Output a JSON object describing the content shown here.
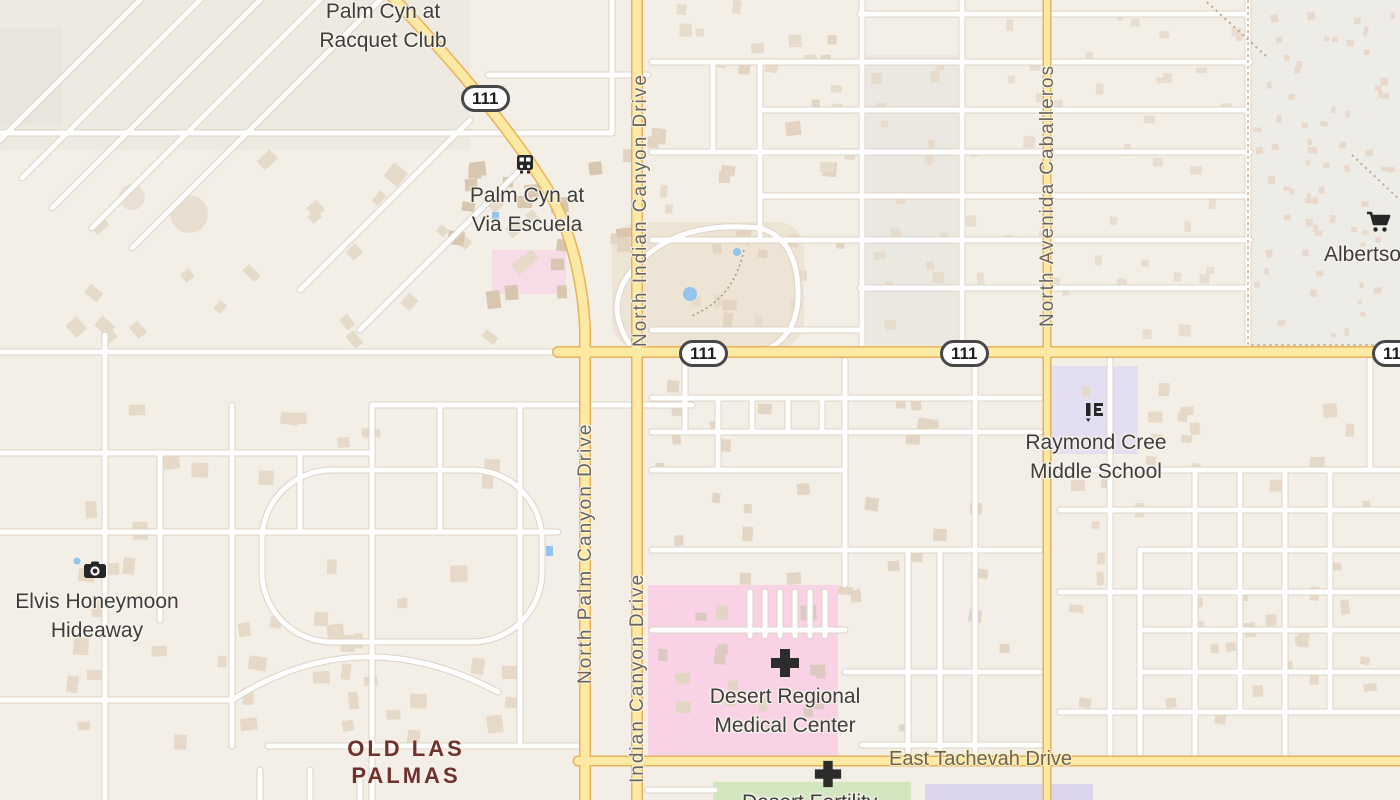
{
  "app": {
    "type": "web-map",
    "description": "street map of north Palm Springs area"
  },
  "colors": {
    "bg": "#f3efe7",
    "road_major_fill": "#fce9a4",
    "road_major_casing": "#e9b258",
    "road_minor_fill": "#ffffff",
    "road_minor_casing": "#dcd3c6",
    "area_hospital": "#f9d2e5",
    "area_school": "#e4def2",
    "area_park": "#d2e7c0",
    "area_purple": "#dcd5ee",
    "poi": "#3d3d3d",
    "street": "#6f6355",
    "nbhd": "#6e312c",
    "water": "#93c4ee"
  },
  "route_shield": "111",
  "labels": {
    "palm_cyn_racquet": {
      "line1": "Palm Cyn at",
      "line2": "Racquet Club"
    },
    "palm_cyn_escuela": {
      "line1": "Palm Cyn at",
      "line2": "Via Escuela"
    },
    "raymond_cree": {
      "line1": "Raymond Cree",
      "line2": "Middle School"
    },
    "albertsons": {
      "text": "Albertsons"
    },
    "elvis": {
      "line1": "Elvis Honeymoon",
      "line2": "Hideaway"
    },
    "old_las_palmas": {
      "line1": "OLD LAS",
      "line2": "PALMAS"
    },
    "desert_regional": {
      "line1": "Desert Regional",
      "line2": "Medical Center"
    },
    "desert_fertility": {
      "text": "Desert Fertility"
    },
    "east_tachevah": {
      "text": "East Tachevah Drive"
    }
  },
  "streets": {
    "north_indian_canyon": "North Indian Canyon Drive",
    "north_palm_canyon": "North Palm Canyon Drive",
    "indian_canyon": "Indian Canyon Drive",
    "avenida_caballeros": "North Avenida Caballeros"
  },
  "icons": {
    "bus": "bus-icon",
    "camera": "camera-icon",
    "cart": "shopping-cart-icon",
    "school": "school-icon",
    "hospital_cross": "hospital-cross-icon",
    "medical_cross": "medical-cross-icon",
    "water": "pool-icon"
  }
}
